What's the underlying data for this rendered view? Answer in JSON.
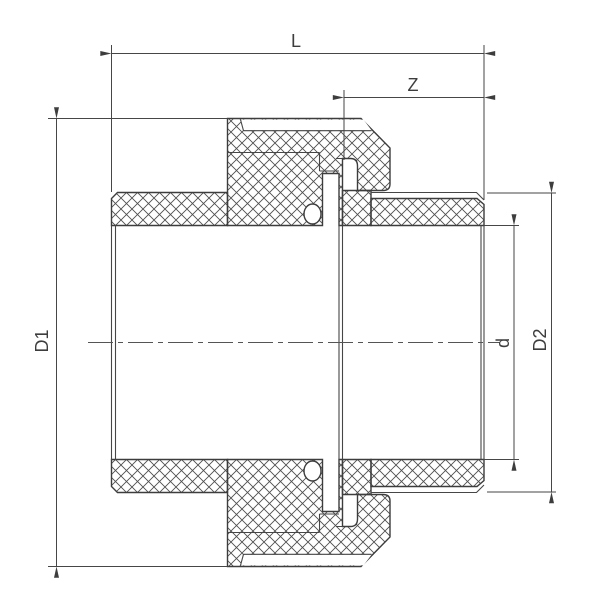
{
  "drawing": {
    "type": "technical-section-drawing",
    "subject": "pipe union fitting cross-section",
    "dimension_labels": {
      "overall_length": "L",
      "insertion_depth": "Z",
      "nut_outer_diameter": "D1",
      "bore_diameter": "d",
      "spigot_outer_diameter": "D2"
    },
    "colors": {
      "line": "#3d3d3d",
      "hatch": "#4f4f4f",
      "background": "#ffffff"
    }
  }
}
